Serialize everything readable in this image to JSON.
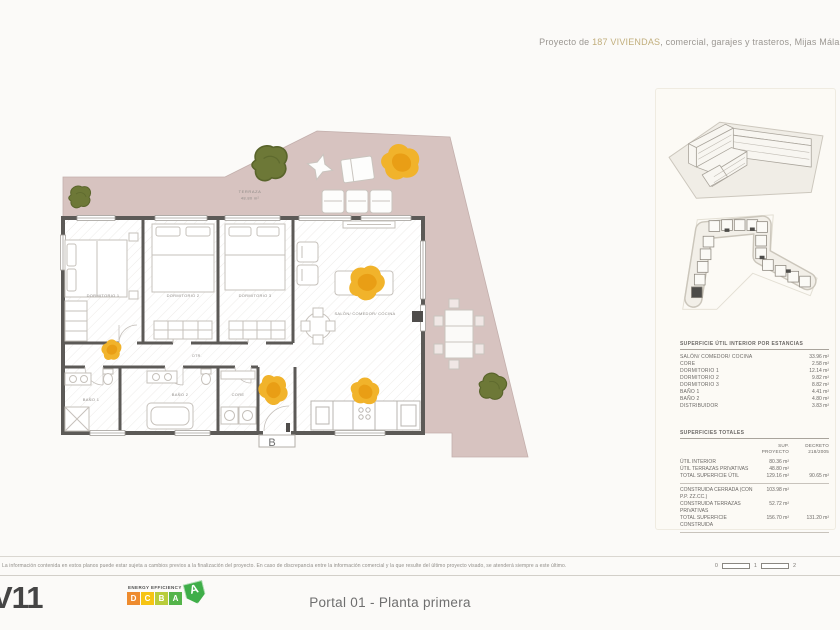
{
  "colors": {
    "terrace": "#d7c3c0",
    "gold": "#f1b32b",
    "gold_dark": "#e79a12",
    "olive": "#6d7837",
    "wall": "#5c5a57",
    "accent_text": "#c1ae7c",
    "energy_d": "#ee8b2e",
    "energy_c": "#f6c413",
    "energy_b": "#b8cc3a",
    "energy_a": "#54b44a"
  },
  "header": {
    "prefix": "Proyecto de ",
    "highlight": "187 VIVIENDAS",
    "suffix": ", comercial, garajes y trasteros, Mijas Málaga"
  },
  "plan": {
    "terrace_label": "TERRAZA",
    "terrace_area": "48.80 m²",
    "portal_letter": "B",
    "rooms": {
      "dorm1": "DORMITORIO 1",
      "dorm2": "DORMITORIO 2",
      "dorm3": "DORMITORIO 3",
      "salon": "SALÓN/ COMEDOR/ COCINA",
      "bano1": "BAÑO 1",
      "bano2": "BAÑO 2",
      "core": "CORE",
      "dtr": "DTR."
    }
  },
  "sidebar": {
    "table_estancias": {
      "title": "SUPERFICIE ÚTIL INTERIOR POR ESTANCIAS",
      "rows": [
        {
          "label": "SALÓN/ COMEDOR/ COCINA",
          "value": "33.96 m²"
        },
        {
          "label": "CORE",
          "value": "2.58 m²"
        },
        {
          "label": "DORMITORIO 1",
          "value": "12.14 m²"
        },
        {
          "label": "DORMITORIO 2",
          "value": "9.82 m²"
        },
        {
          "label": "DORMITORIO 3",
          "value": "8.82 m²"
        },
        {
          "label": "BAÑO 1",
          "value": "4.41 m²"
        },
        {
          "label": "BAÑO 2",
          "value": "4.80 m²"
        },
        {
          "label": "DISTRIBUIDOR",
          "value": "3.83 m²"
        }
      ]
    },
    "table_totales": {
      "title": "SUPERFICIES TOTALES",
      "col1": "SUP. PROYECTO",
      "col2": "DECRETO 218/2005",
      "rows": [
        {
          "label": "ÚTIL INTERIOR",
          "v1": "80.36 m²",
          "v2": ""
        },
        {
          "label": "ÚTIL TERRAZAS PRIVATIVAS",
          "v1": "48.80 m²",
          "v2": ""
        },
        {
          "label": "TOTAL SUPERFICIE ÚTIL",
          "v1": "129.16 m²",
          "v2": "90.65 m²"
        },
        {
          "label": "CONSTRUIDA CERRADA (CON P.P. ZZ.CC.)",
          "v1": "103.98 m²",
          "v2": ""
        },
        {
          "label": "CONSTRUIDA TERRAZAS PRIVATIVAS",
          "v1": "52.72 m²",
          "v2": ""
        },
        {
          "label": "TOTAL SUPERFICIE CONSTRUIDA",
          "v1": "156.70 m²",
          "v2": "131.20 m²"
        }
      ]
    }
  },
  "footer": {
    "disclaimer": "La información contenida en estos planos puede estar sujeta a cambios previos a la finalización del proyecto. En caso de discrepancia entre la información comercial y la que resulte del último proyecto visado, se atenderá siempre a este último.",
    "scale": [
      "0",
      "1",
      "2"
    ],
    "version": "V11",
    "plan_title": "Portal 01 - Planta primera",
    "energy": {
      "title": "ENERGY EFFICIENCY",
      "letters": [
        "D",
        "C",
        "B",
        "A"
      ],
      "rating": "A"
    }
  }
}
